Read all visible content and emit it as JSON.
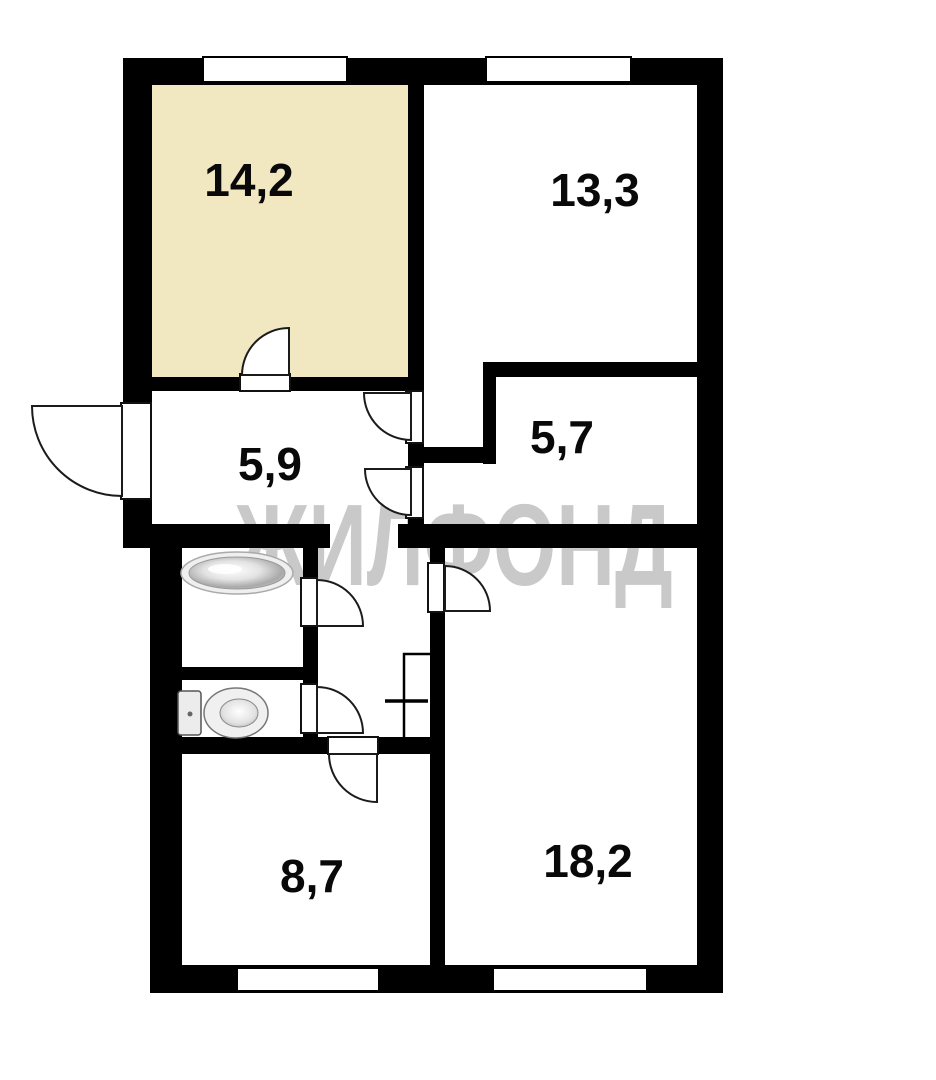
{
  "plan": {
    "title": "apartment-floor-plan",
    "watermark": "ЖИЛФОНД",
    "rooms": [
      {
        "label": "14,2",
        "highlighted": true,
        "fill": "#F1E8C2"
      },
      {
        "label": "13,3",
        "highlighted": false,
        "fill": "#FFFFFF"
      },
      {
        "label": "5,9",
        "highlighted": false,
        "fill": "#FFFFFF"
      },
      {
        "label": "5,7",
        "highlighted": false,
        "fill": "#FFFFFF"
      },
      {
        "label": "8,7",
        "highlighted": false,
        "fill": "#FFFFFF"
      },
      {
        "label": "18,2",
        "highlighted": false,
        "fill": "#FFFFFF"
      }
    ],
    "fixtures": [
      {
        "name": "bathtub"
      },
      {
        "name": "toilet"
      },
      {
        "name": "vent-shaft"
      }
    ],
    "features": {
      "windows": 4,
      "doors": 8,
      "entrance_side": "left"
    },
    "colors": {
      "wall": "#000000",
      "highlight_room_fill": "#F1E8C2",
      "watermark": "#C9C9C9",
      "floor": "#FFFFFF"
    }
  }
}
